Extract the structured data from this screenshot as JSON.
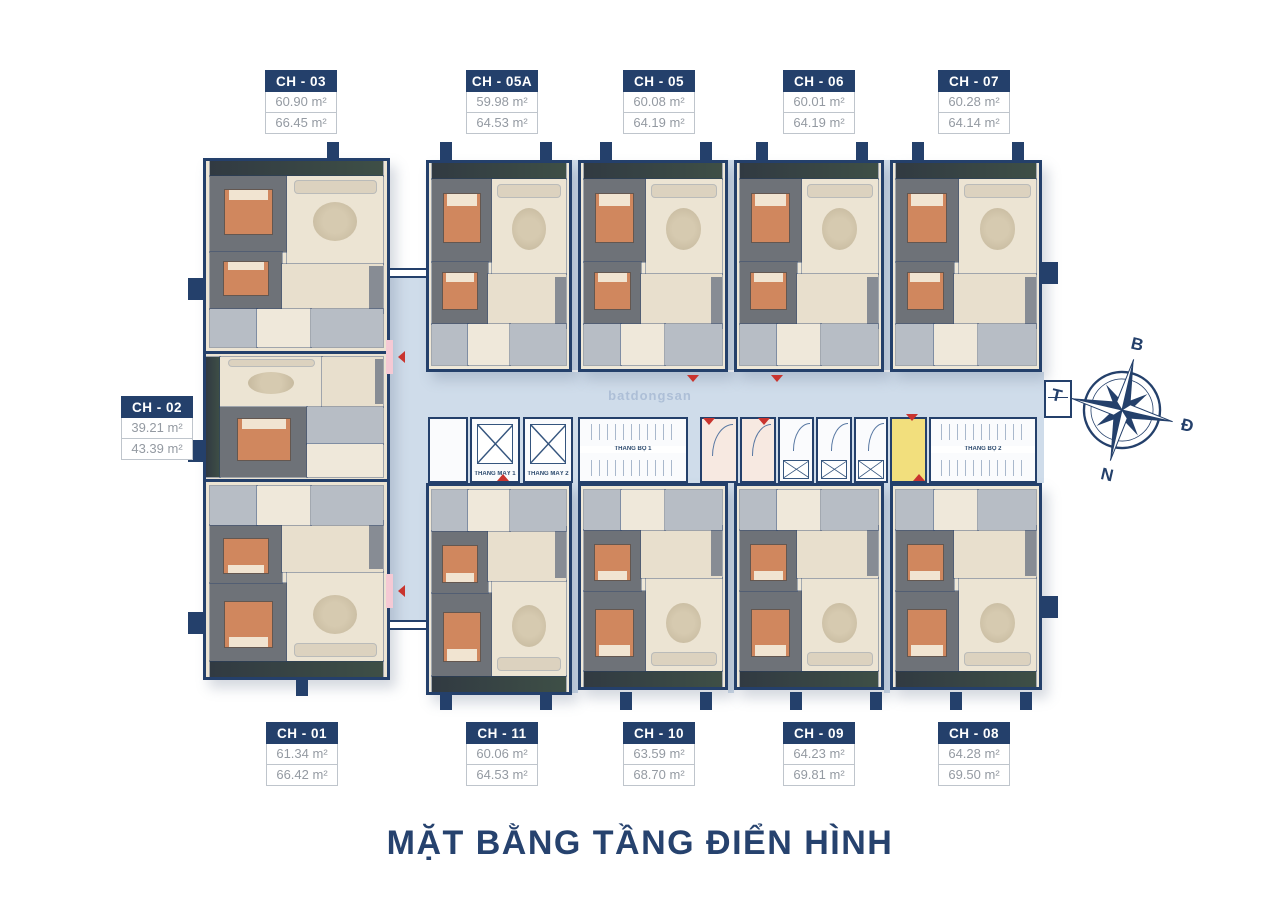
{
  "title": "MẶT BẰNG TẦNG ĐIỂN HÌNH",
  "watermark": "batdongsan",
  "compass": {
    "north": "B",
    "east": "Đ",
    "south": "N",
    "west": "T"
  },
  "service": {
    "elevator1": "THANG MÁY 1",
    "elevator2": "THANG MÁY 2",
    "stair1": "THANG BỘ 1",
    "stair2": "THANG BỘ 2"
  },
  "units": [
    {
      "id": "ch01",
      "label": "CH - 01",
      "area1": "61.34 m²",
      "area2": "66.42 m²"
    },
    {
      "id": "ch02",
      "label": "CH - 02",
      "area1": "39.21 m²",
      "area2": "43.39 m²"
    },
    {
      "id": "ch03",
      "label": "CH - 03",
      "area1": "60.90 m²",
      "area2": "66.45 m²"
    },
    {
      "id": "ch05a",
      "label": "CH - 05A",
      "area1": "59.98 m²",
      "area2": "64.53 m²"
    },
    {
      "id": "ch05",
      "label": "CH - 05",
      "area1": "60.08 m²",
      "area2": "64.19 m²"
    },
    {
      "id": "ch06",
      "label": "CH - 06",
      "area1": "60.01 m²",
      "area2": "64.19 m²"
    },
    {
      "id": "ch07",
      "label": "CH - 07",
      "area1": "60.28 m²",
      "area2": "64.14 m²"
    },
    {
      "id": "ch08",
      "label": "CH - 08",
      "area1": "64.28 m²",
      "area2": "69.50 m²"
    },
    {
      "id": "ch09",
      "label": "CH - 09",
      "area1": "64.23 m²",
      "area2": "69.81 m²"
    },
    {
      "id": "ch10",
      "label": "CH - 10",
      "area1": "63.59 m²",
      "area2": "68.70 m²"
    },
    {
      "id": "ch11",
      "label": "CH - 11",
      "area1": "60.06 m²",
      "area2": "64.53 m²"
    }
  ],
  "colors": {
    "navy": "#24406b",
    "slab": "#cfdcea",
    "floor": "#ece4d3",
    "bedroom": "#6e7278",
    "bed": "#d0875e",
    "bath": "#b7bdc5",
    "balcony": "#363f47",
    "yellow": "#f2df7d",
    "cream": "#f7e9e1",
    "marker": "#c9342e"
  }
}
